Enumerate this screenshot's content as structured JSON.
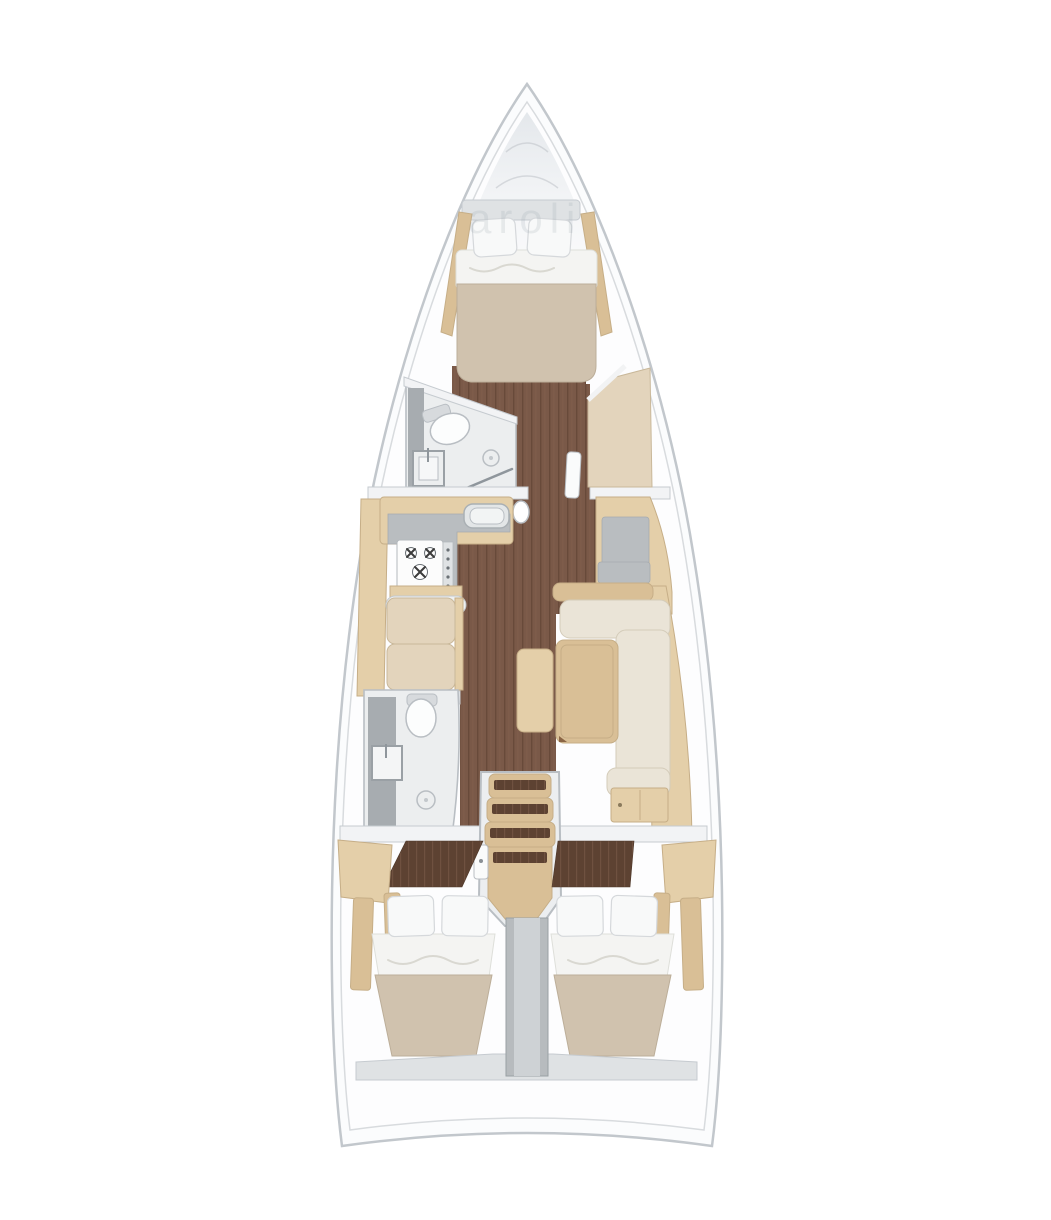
{
  "scene": {
    "kind": "sailboat-interior-floor-plan",
    "orientation": "bow-up",
    "watermark": {
      "text": "aroli"
    }
  },
  "palette": {
    "hull_line": "#c2c7cc",
    "hull_line_light": "#d8dbde",
    "deck_white": "#fbfcfd",
    "bow_shade": "#e2e6ea",
    "floor_wood": "#7a5948",
    "floor_line": "#684a3a",
    "floor_light": "#8a6552",
    "wood_light": "#e4cfa9",
    "wood_mid": "#d9bf96",
    "wood_edge": "#c6ae87",
    "walnut": "#5d4232",
    "walnut_line": "#6f5140",
    "cushion": "#e3d4bc",
    "cushion_edge": "#c9b89a",
    "cream": "#eae4d7",
    "cream_edge": "#d4ccba",
    "mattress": "#d0c2ae",
    "mattress_edge": "#bcae99",
    "bedding": "#f4f4f2",
    "gray_counter": "#b9bdc0",
    "shower_gray": "#a7acb0",
    "bath_floor": "#eceeef",
    "divider": "#b7bbbe",
    "divider_light": "#ced2d5",
    "shelf": "#dfe2e4",
    "white_panel": "#f2f3f5",
    "outline_gray": "#b9bec3",
    "burner": "#3c3c3c",
    "watermark": "#97a2ac"
  },
  "regions": [
    {
      "id": "v-berth-cabin",
      "label": "bow V-berth double cabin"
    },
    {
      "id": "forward-head",
      "label": "forward head with toilet, sink and shower drain"
    },
    {
      "id": "galley",
      "label": "port L-galley with sink and 3-burner stove"
    },
    {
      "id": "port-settee",
      "label": "port two-cushion settee"
    },
    {
      "id": "nav-station",
      "label": "starboard nav seat / chart area"
    },
    {
      "id": "salon",
      "label": "starboard L-sofa with table and stool"
    },
    {
      "id": "aft-head",
      "label": "aft head with toilet, sink and shower"
    },
    {
      "id": "companionway",
      "label": "companionway steps with wood treads"
    },
    {
      "id": "aft-cabin-port",
      "label": "port aft double cabin"
    },
    {
      "id": "aft-cabin-starboard",
      "label": "starboard aft double cabin"
    },
    {
      "id": "engine-divider",
      "label": "central engine/berth divider"
    }
  ],
  "fixtures": {
    "toilets": 2,
    "sinks": 3,
    "shower_drains": 2,
    "stove_burners": 3,
    "pillows": 6,
    "double_beds": 3
  }
}
